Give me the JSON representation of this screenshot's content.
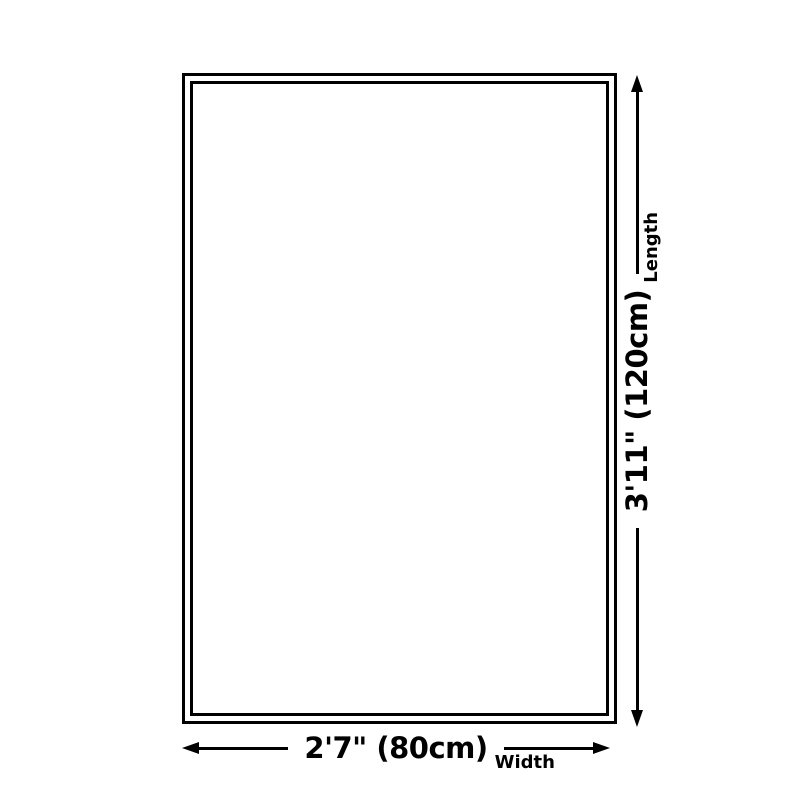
{
  "diagram": {
    "type": "product-dimension-diagram",
    "background_color": "#ffffff",
    "line_color": "#000000",
    "product": {
      "shape": "rectangle",
      "border_style": "double-outline"
    },
    "width_dimension": {
      "value": "2'7\" (80cm)",
      "label": "Width",
      "orientation": "horizontal",
      "arrow": "double-headed"
    },
    "length_dimension": {
      "value": "3'11\" (120cm)",
      "label": "Length",
      "orientation": "vertical",
      "arrow": "double-headed"
    }
  }
}
